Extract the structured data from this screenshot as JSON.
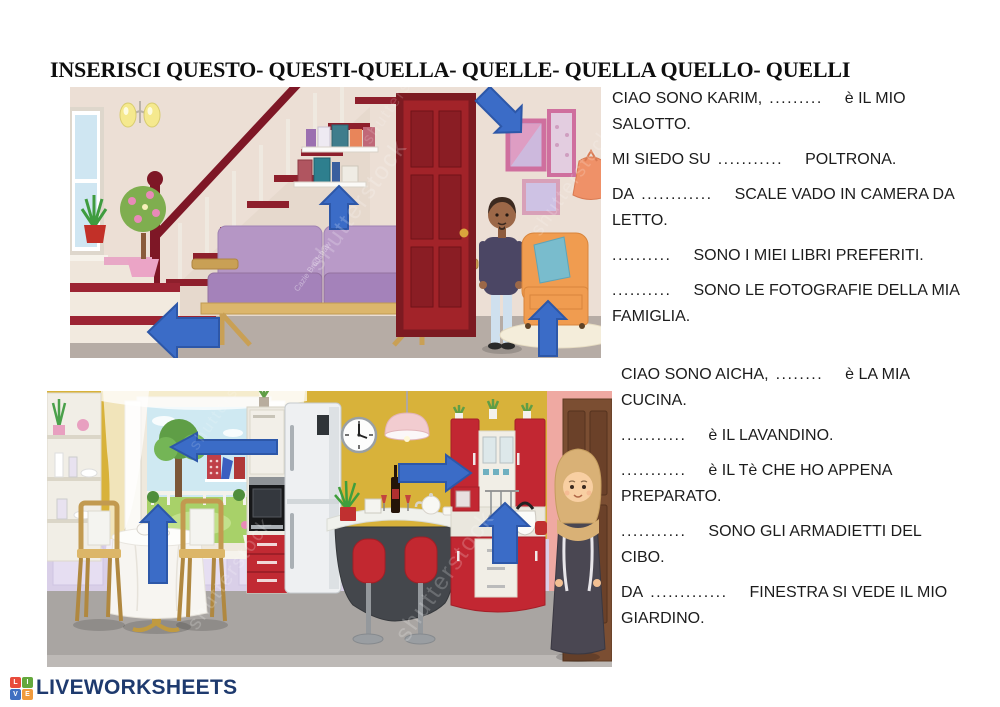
{
  "title": "INSERISCI QUESTO- QUESTI-QUELLA- QUELLE- QUELLA QUELLO- QUELLI",
  "watermarks": {
    "stock": "shutterstock",
    "credit": "Cazie Bradshaw"
  },
  "exercise": {
    "karim": [
      {
        "pre": "CIAO SONO KARIM,",
        "blank": ".........",
        "post": "è IL MIO\nSALOTTO."
      },
      {
        "pre": "MI SIEDO SU",
        "blank": "...........",
        "post": "POLTRONA."
      },
      {
        "pre": "DA",
        "blank": "............",
        "post": "SCALE VADO IN CAMERA DA\nLETTO."
      },
      {
        "pre": "",
        "blank": "..........",
        "post": "SONO I MIEI LIBRI PREFERITI."
      },
      {
        "pre": "",
        "blank": "..........",
        "post": "SONO LE FOTOGRAFIE DELLA MIA\nFAMIGLIA."
      }
    ],
    "aicha": [
      {
        "pre": "CIAO SONO AICHA,",
        "blank": "........",
        "post": "è LA MIA\nCUCINA."
      },
      {
        "pre": "",
        "blank": "...........",
        "post": "è IL LAVANDINO."
      },
      {
        "pre": "",
        "blank": "...........",
        "post": "è IL Tè CHE HO APPENA\nPREPARATO."
      },
      {
        "pre": "",
        "blank": "...........",
        "post": "SONO GLI ARMADIETTI DEL\nCIBO."
      },
      {
        "pre": "DA",
        "blank": ".............",
        "post": "FINESTRA SI VEDE IL MIO\nGIARDINO."
      }
    ]
  },
  "footer": {
    "brand": "LIVEWORKSHEETS",
    "logo_letters": [
      "L",
      "I",
      "V",
      "E"
    ]
  },
  "colors": {
    "arrow": "#3b6cc7",
    "arrow_border": "#2d57a8",
    "brand_navy": "#1e3a6e",
    "living_wall": "#ecdfd5",
    "kitchen_wall": "#d8b23a",
    "door_red": "#a22329"
  }
}
